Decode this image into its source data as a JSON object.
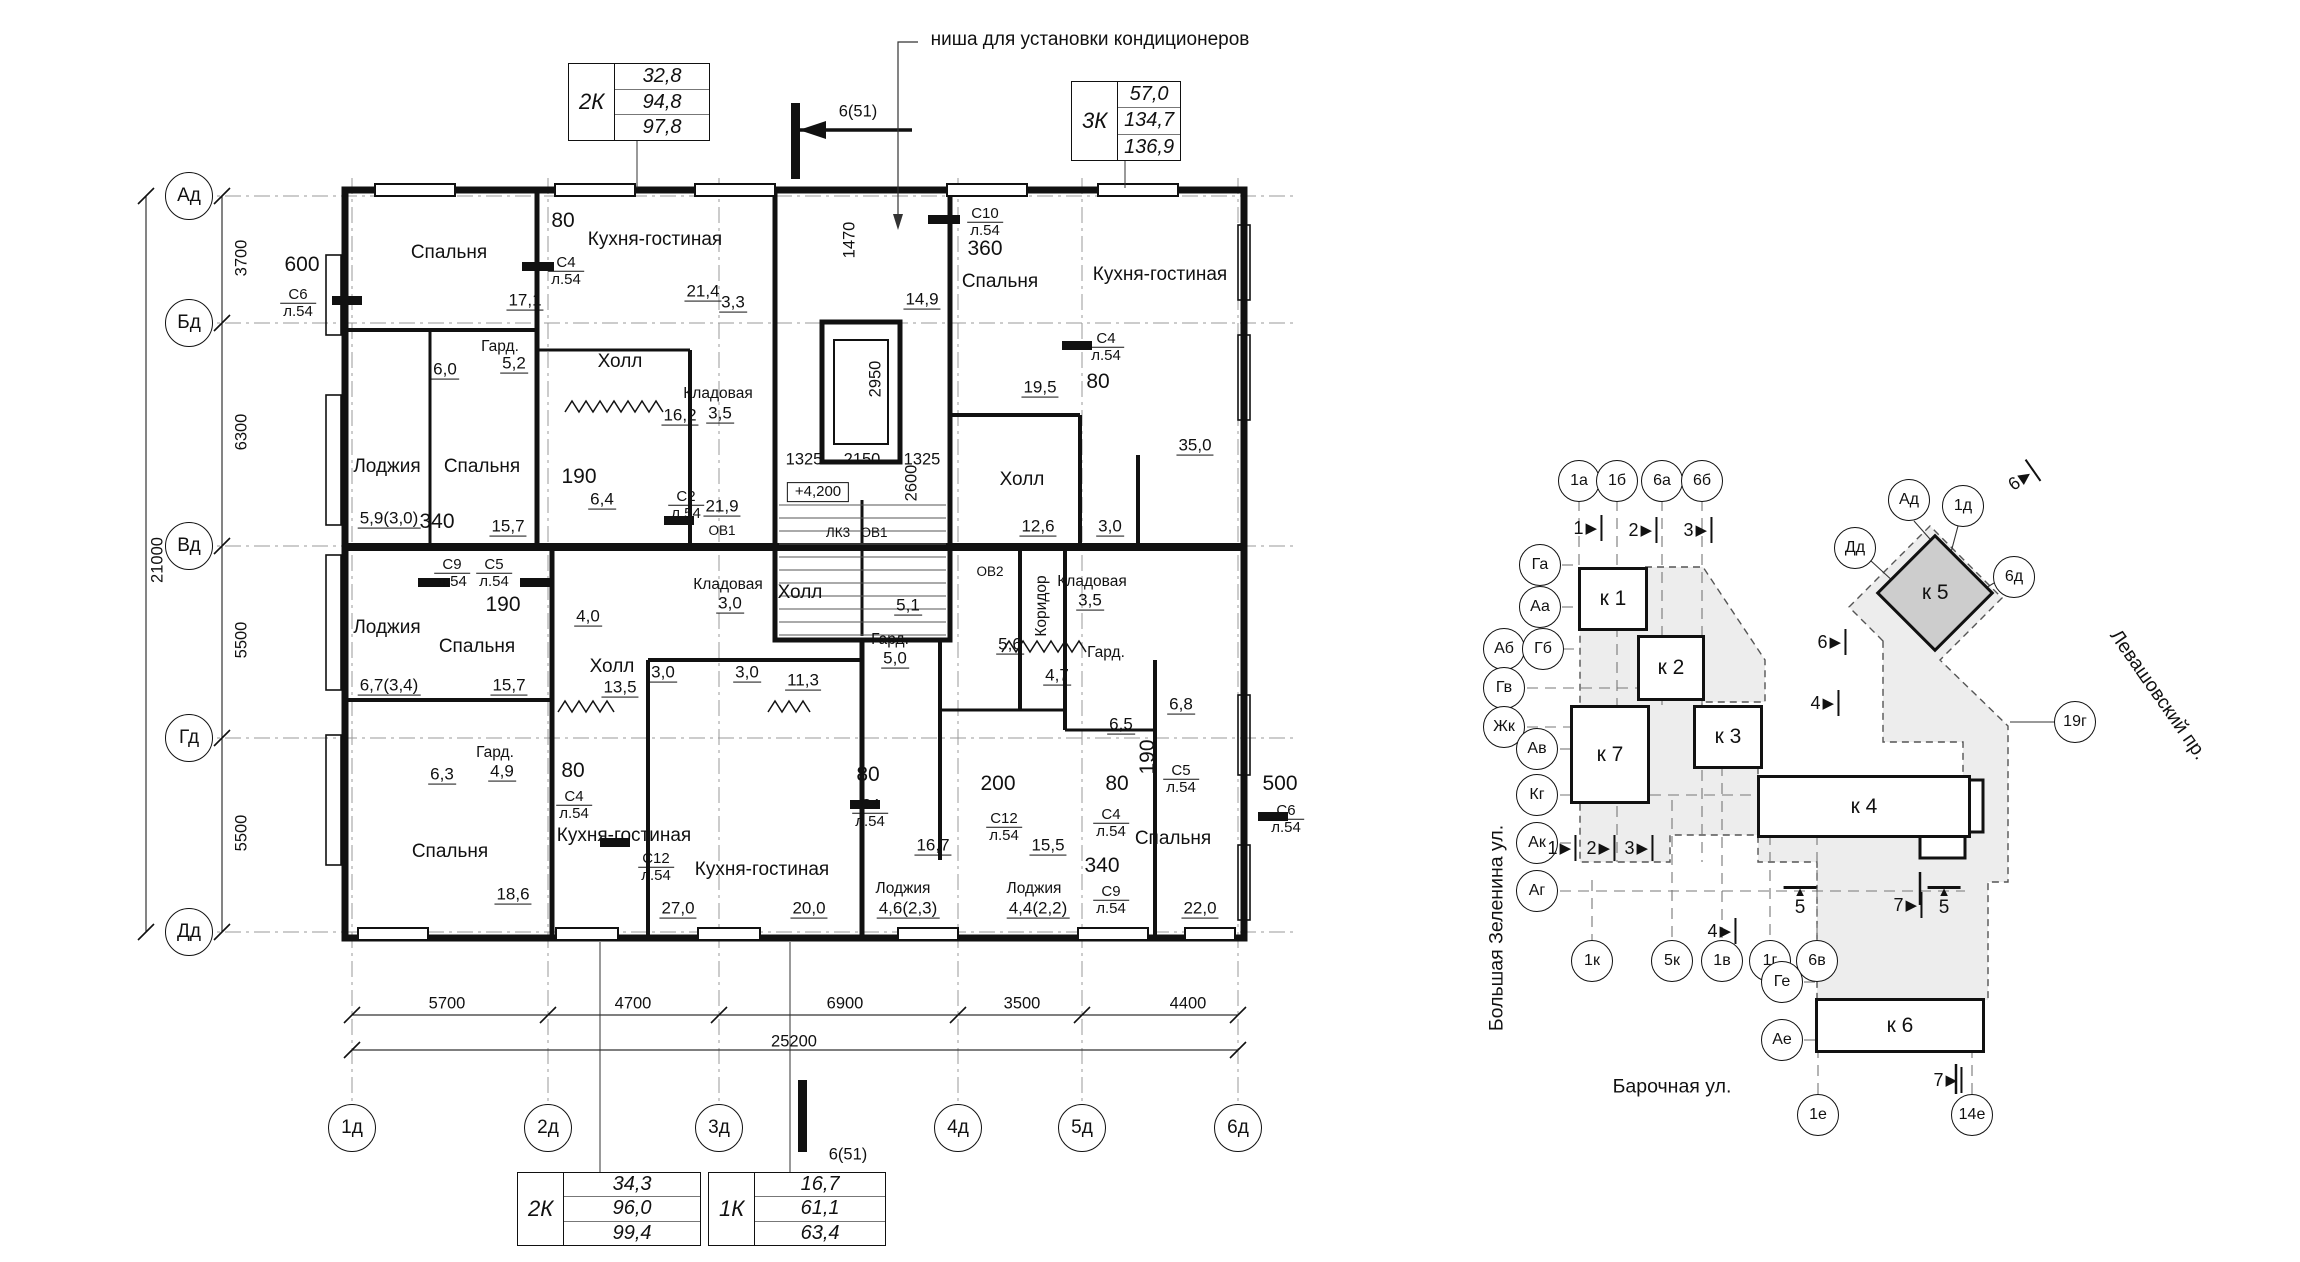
{
  "floor_plan": {
    "note": "ниша для установки кондиционеров",
    "area_tables": [
      {
        "label": "2К",
        "values": [
          "32,8",
          "94,8",
          "97,8"
        ],
        "x": 568,
        "y": 63,
        "w": 140,
        "h": 76
      },
      {
        "label": "3К",
        "values": [
          "57,0",
          "134,7",
          "136,9"
        ],
        "x": 1071,
        "y": 81,
        "w": 108,
        "h": 78
      },
      {
        "label": "2К",
        "values": [
          "34,3",
          "96,0",
          "99,4"
        ],
        "x": 517,
        "y": 1172,
        "w": 182,
        "h": 72
      },
      {
        "label": "1К",
        "values": [
          "16,7",
          "61,1",
          "63,4"
        ],
        "x": 708,
        "y": 1172,
        "w": 176,
        "h": 72
      }
    ],
    "axes_left": [
      {
        "label": "Ад",
        "y": 196
      },
      {
        "label": "Бд",
        "y": 323
      },
      {
        "label": "Вд",
        "y": 546
      },
      {
        "label": "Гд",
        "y": 738
      },
      {
        "label": "Дд",
        "y": 932
      }
    ],
    "axes_bottom": [
      {
        "label": "1д",
        "x": 352
      },
      {
        "label": "2д",
        "x": 548
      },
      {
        "label": "3д",
        "x": 719
      },
      {
        "label": "4д",
        "x": 958
      },
      {
        "label": "5д",
        "x": 1082
      },
      {
        "label": "6д",
        "x": 1238
      }
    ],
    "dims_left": [
      {
        "text": "3700",
        "x": 242,
        "y": 258
      },
      {
        "text": "6300",
        "x": 242,
        "y": 432
      },
      {
        "text": "5500",
        "x": 242,
        "y": 640
      },
      {
        "text": "5500",
        "x": 242,
        "y": 833
      },
      {
        "text": "21000",
        "x": 158,
        "y": 560
      }
    ],
    "dims_bottom": [
      {
        "text": "5700",
        "x": 447,
        "y": 1004
      },
      {
        "text": "4700",
        "x": 633,
        "y": 1004
      },
      {
        "text": "6900",
        "x": 845,
        "y": 1004
      },
      {
        "text": "3500",
        "x": 1022,
        "y": 1004
      },
      {
        "text": "4400",
        "x": 1188,
        "y": 1004
      },
      {
        "text": "25200",
        "x": 794,
        "y": 1042
      }
    ],
    "labels": [
      {
        "t": "Спальня",
        "x": 449,
        "y": 253,
        "c": "r"
      },
      {
        "t": "Кухня-гостиная",
        "x": 655,
        "y": 240,
        "c": "r"
      },
      {
        "t": "Спальня",
        "x": 1000,
        "y": 282,
        "c": "r"
      },
      {
        "t": "Кухня-гостиная",
        "x": 1160,
        "y": 275,
        "c": "r"
      },
      {
        "t": "Холл",
        "x": 620,
        "y": 362,
        "c": "r"
      },
      {
        "t": "Холл",
        "x": 1022,
        "y": 480,
        "c": "r"
      },
      {
        "t": "Лоджия",
        "x": 387,
        "y": 467,
        "c": "r"
      },
      {
        "t": "Спальня",
        "x": 482,
        "y": 467,
        "c": "r"
      },
      {
        "t": "Лоджия",
        "x": 387,
        "y": 628,
        "c": "r"
      },
      {
        "t": "Спальня",
        "x": 477,
        "y": 647,
        "c": "r"
      },
      {
        "t": "Холл",
        "x": 612,
        "y": 667,
        "c": "r"
      },
      {
        "t": "Холл",
        "x": 800,
        "y": 593,
        "c": "r"
      },
      {
        "t": "Спальня",
        "x": 450,
        "y": 852,
        "c": "r"
      },
      {
        "t": "Кухня-гостиная",
        "x": 624,
        "y": 836,
        "c": "r"
      },
      {
        "t": "Кухня-гостиная",
        "x": 762,
        "y": 870,
        "c": "r"
      },
      {
        "t": "Спальня",
        "x": 1173,
        "y": 839,
        "c": "r"
      },
      {
        "t": "Кладовая",
        "x": 718,
        "y": 394,
        "c": "rs"
      },
      {
        "t": "3,5",
        "x": 720,
        "y": 414,
        "c": "a"
      },
      {
        "t": "Кладовая",
        "x": 728,
        "y": 585,
        "c": "rs"
      },
      {
        "t": "3,0",
        "x": 730,
        "y": 604,
        "c": "a"
      },
      {
        "t": "Кладовая",
        "x": 1092,
        "y": 582,
        "c": "rs"
      },
      {
        "t": "3,5",
        "x": 1090,
        "y": 601,
        "c": "a"
      },
      {
        "t": "Гард.",
        "x": 500,
        "y": 347,
        "c": "rs"
      },
      {
        "t": "5,2",
        "x": 514,
        "y": 364,
        "c": "a"
      },
      {
        "t": "Гард.",
        "x": 495,
        "y": 753,
        "c": "rs"
      },
      {
        "t": "4,9",
        "x": 502,
        "y": 772,
        "c": "a"
      },
      {
        "t": "Гард.",
        "x": 890,
        "y": 640,
        "c": "rs"
      },
      {
        "t": "5,0",
        "x": 895,
        "y": 659,
        "c": "a"
      },
      {
        "t": "Гард.",
        "x": 1106,
        "y": 653,
        "c": "rs"
      },
      {
        "t": "Коридор",
        "x": 1042,
        "y": 606,
        "c": "rs",
        "r": -90
      },
      {
        "t": "Лоджия",
        "x": 903,
        "y": 889,
        "c": "rs"
      },
      {
        "t": "4,6(2,3)",
        "x": 908,
        "y": 909,
        "c": "a"
      },
      {
        "t": "Лоджия",
        "x": 1034,
        "y": 889,
        "c": "rs"
      },
      {
        "t": "4,4(2,2)",
        "x": 1038,
        "y": 909,
        "c": "a"
      },
      {
        "t": "17,1",
        "x": 525,
        "y": 301,
        "c": "a"
      },
      {
        "t": "21,4",
        "x": 703,
        "y": 292,
        "c": "a"
      },
      {
        "t": "16,2",
        "x": 680,
        "y": 416,
        "c": "a"
      },
      {
        "t": "3,3",
        "x": 733,
        "y": 303,
        "c": "a"
      },
      {
        "t": "6,0",
        "x": 445,
        "y": 370,
        "c": "a"
      },
      {
        "t": "35,0",
        "x": 1195,
        "y": 446,
        "c": "a"
      },
      {
        "t": "19,5",
        "x": 1040,
        "y": 388,
        "c": "a"
      },
      {
        "t": "12,6",
        "x": 1038,
        "y": 527,
        "c": "a"
      },
      {
        "t": "3,0",
        "x": 1110,
        "y": 527,
        "c": "a"
      },
      {
        "t": "14,9",
        "x": 922,
        "y": 300,
        "c": "a"
      },
      {
        "t": "5,9(3,0)",
        "x": 389,
        "y": 519,
        "c": "a"
      },
      {
        "t": "15,7",
        "x": 508,
        "y": 527,
        "c": "a"
      },
      {
        "t": "6,4",
        "x": 602,
        "y": 500,
        "c": "a"
      },
      {
        "t": "21,9",
        "x": 722,
        "y": 507,
        "c": "a"
      },
      {
        "t": "4,0",
        "x": 588,
        "y": 617,
        "c": "a"
      },
      {
        "t": "13,5",
        "x": 620,
        "y": 688,
        "c": "a"
      },
      {
        "t": "11,3",
        "x": 803,
        "y": 681,
        "c": "a"
      },
      {
        "t": "3,0",
        "x": 663,
        "y": 673,
        "c": "a"
      },
      {
        "t": "3,0",
        "x": 747,
        "y": 673,
        "c": "a"
      },
      {
        "t": "5,1",
        "x": 908,
        "y": 606,
        "c": "a"
      },
      {
        "t": "5,6",
        "x": 1010,
        "y": 645,
        "c": "a"
      },
      {
        "t": "4,7",
        "x": 1057,
        "y": 676,
        "c": "a"
      },
      {
        "t": "6,7(3,4)",
        "x": 389,
        "y": 686,
        "c": "a"
      },
      {
        "t": "15,7",
        "x": 509,
        "y": 686,
        "c": "a"
      },
      {
        "t": "6,3",
        "x": 442,
        "y": 775,
        "c": "a"
      },
      {
        "t": "18,6",
        "x": 513,
        "y": 895,
        "c": "a"
      },
      {
        "t": "27,0",
        "x": 678,
        "y": 909,
        "c": "a"
      },
      {
        "t": "20,0",
        "x": 809,
        "y": 909,
        "c": "a"
      },
      {
        "t": "16,7",
        "x": 933,
        "y": 846,
        "c": "a"
      },
      {
        "t": "15,5",
        "x": 1048,
        "y": 846,
        "c": "a"
      },
      {
        "t": "22,0",
        "x": 1200,
        "y": 909,
        "c": "a"
      },
      {
        "t": "6,5",
        "x": 1121,
        "y": 725,
        "c": "a"
      },
      {
        "t": "6,8",
        "x": 1181,
        "y": 705,
        "c": "a"
      },
      {
        "t": "600",
        "x": 302,
        "y": 265,
        "c": "o"
      },
      {
        "t": "80",
        "x": 563,
        "y": 221,
        "c": "o"
      },
      {
        "t": "340",
        "x": 437,
        "y": 522,
        "c": "o"
      },
      {
        "t": "190",
        "x": 579,
        "y": 477,
        "c": "o"
      },
      {
        "t": "190",
        "x": 503,
        "y": 605,
        "c": "o"
      },
      {
        "t": "80",
        "x": 1098,
        "y": 382,
        "c": "o"
      },
      {
        "t": "360",
        "x": 985,
        "y": 249,
        "c": "o"
      },
      {
        "t": "80",
        "x": 573,
        "y": 771,
        "c": "o"
      },
      {
        "t": "80",
        "x": 868,
        "y": 775,
        "c": "o"
      },
      {
        "t": "200",
        "x": 998,
        "y": 784,
        "c": "o"
      },
      {
        "t": "80",
        "x": 1117,
        "y": 784,
        "c": "o"
      },
      {
        "t": "340",
        "x": 1102,
        "y": 866,
        "c": "o"
      },
      {
        "t": "500",
        "x": 1280,
        "y": 784,
        "c": "o"
      },
      {
        "t": "190",
        "x": 1148,
        "y": 757,
        "c": "o",
        "r": -90
      },
      {
        "t": "1470",
        "x": 850,
        "y": 240,
        "c": "d",
        "r": -90
      },
      {
        "t": "2950",
        "x": 876,
        "y": 379,
        "c": "d",
        "r": -90
      },
      {
        "t": "2600",
        "x": 912,
        "y": 483,
        "c": "d",
        "r": -90
      },
      {
        "t": "1325",
        "x": 804,
        "y": 460,
        "c": "d"
      },
      {
        "t": "2150",
        "x": 862,
        "y": 460,
        "c": "d"
      },
      {
        "t": "1325",
        "x": 922,
        "y": 460,
        "c": "d"
      },
      {
        "t": "6(51)",
        "x": 858,
        "y": 112,
        "c": "d"
      },
      {
        "t": "6(51)",
        "x": 848,
        "y": 1155,
        "c": "d"
      },
      {
        "t": "С6|л.54",
        "x": 298,
        "y": 303,
        "c": "s"
      },
      {
        "t": "С4|л.54",
        "x": 566,
        "y": 271,
        "c": "s"
      },
      {
        "t": "С10|л.54",
        "x": 985,
        "y": 222,
        "c": "s"
      },
      {
        "t": "С4|л.54",
        "x": 1106,
        "y": 347,
        "c": "s"
      },
      {
        "t": "С2|л.54",
        "x": 686,
        "y": 505,
        "c": "s"
      },
      {
        "t": "С9|л.54",
        "x": 452,
        "y": 573,
        "c": "s"
      },
      {
        "t": "С5|л.54",
        "x": 494,
        "y": 573,
        "c": "s"
      },
      {
        "t": "С4|л.54",
        "x": 574,
        "y": 805,
        "c": "s"
      },
      {
        "t": "С12|л.54",
        "x": 656,
        "y": 867,
        "c": "s"
      },
      {
        "t": "С4|л.54",
        "x": 870,
        "y": 813,
        "c": "s"
      },
      {
        "t": "С12|л.54",
        "x": 1004,
        "y": 827,
        "c": "s"
      },
      {
        "t": "С9|л.54",
        "x": 1111,
        "y": 900,
        "c": "s"
      },
      {
        "t": "С4|л.54",
        "x": 1111,
        "y": 823,
        "c": "s"
      },
      {
        "t": "С5|л.54",
        "x": 1181,
        "y": 779,
        "c": "s"
      },
      {
        "t": "С6|л.54",
        "x": 1286,
        "y": 819,
        "c": "s"
      },
      {
        "t": "ОВ1",
        "x": 722,
        "y": 531,
        "c": "t"
      },
      {
        "t": "ЛК3",
        "x": 838,
        "y": 533,
        "c": "t"
      },
      {
        "t": "ОВ1",
        "x": 874,
        "y": 533,
        "c": "t"
      },
      {
        "t": "ОВ2",
        "x": 990,
        "y": 572,
        "c": "t"
      },
      {
        "t": "+4,200",
        "x": 818,
        "y": 492,
        "c": "e"
      }
    ]
  },
  "site_plan": {
    "buildings": [
      {
        "label": "к 1",
        "x": 1578,
        "y": 567,
        "w": 64,
        "h": 58
      },
      {
        "label": "к 2",
        "x": 1637,
        "y": 635,
        "w": 62,
        "h": 60
      },
      {
        "label": "к 7",
        "x": 1570,
        "y": 705,
        "w": 74,
        "h": 93
      },
      {
        "label": "к 3",
        "x": 1693,
        "y": 705,
        "w": 64,
        "h": 58
      },
      {
        "label": "к 4",
        "x": 1757,
        "y": 775,
        "w": 208,
        "h": 57
      },
      {
        "label": "к 6",
        "x": 1815,
        "y": 998,
        "w": 164,
        "h": 49
      },
      {
        "label": "к 5",
        "x": 1893,
        "y": 551,
        "w": 78,
        "h": 78,
        "shape": "diamond",
        "fill": "#cdcdcd"
      }
    ],
    "bubbles": [
      {
        "t": "1а",
        "x": 1579,
        "y": 481
      },
      {
        "t": "1б",
        "x": 1617,
        "y": 481
      },
      {
        "t": "6а",
        "x": 1662,
        "y": 481
      },
      {
        "t": "6б",
        "x": 1702,
        "y": 481
      },
      {
        "t": "Га",
        "x": 1540,
        "y": 565
      },
      {
        "t": "Аа",
        "x": 1540,
        "y": 607
      },
      {
        "t": "Аб",
        "x": 1504,
        "y": 649
      },
      {
        "t": "Гб",
        "x": 1543,
        "y": 649
      },
      {
        "t": "Гв",
        "x": 1504,
        "y": 688
      },
      {
        "t": "Жк",
        "x": 1504,
        "y": 727
      },
      {
        "t": "Ав",
        "x": 1537,
        "y": 749
      },
      {
        "t": "Кг",
        "x": 1537,
        "y": 795
      },
      {
        "t": "Ак",
        "x": 1537,
        "y": 843
      },
      {
        "t": "Аг",
        "x": 1537,
        "y": 891
      },
      {
        "t": "1к",
        "x": 1592,
        "y": 961
      },
      {
        "t": "5к",
        "x": 1672,
        "y": 961
      },
      {
        "t": "1в",
        "x": 1722,
        "y": 961
      },
      {
        "t": "1г",
        "x": 1770,
        "y": 961
      },
      {
        "t": "6в",
        "x": 1817,
        "y": 961
      },
      {
        "t": "Ад",
        "x": 1909,
        "y": 500
      },
      {
        "t": "1д",
        "x": 1963,
        "y": 506
      },
      {
        "t": "Дд",
        "x": 1855,
        "y": 548
      },
      {
        "t": "6д",
        "x": 2014,
        "y": 577
      },
      {
        "t": "19г",
        "x": 2075,
        "y": 722
      },
      {
        "t": "Ге",
        "x": 1782,
        "y": 982
      },
      {
        "t": "Ае",
        "x": 1782,
        "y": 1040
      },
      {
        "t": "1е",
        "x": 1818,
        "y": 1115
      },
      {
        "t": "14е",
        "x": 1972,
        "y": 1115
      }
    ],
    "markers": [
      {
        "t": "1",
        "g": "right",
        "x": 1588,
        "y": 528
      },
      {
        "t": "2",
        "g": "right",
        "x": 1643,
        "y": 530
      },
      {
        "t": "3",
        "g": "right",
        "x": 1698,
        "y": 530
      },
      {
        "t": "1",
        "g": "right",
        "x": 1562,
        "y": 848
      },
      {
        "t": "2",
        "g": "right",
        "x": 1601,
        "y": 848
      },
      {
        "t": "3",
        "g": "right",
        "x": 1639,
        "y": 848
      },
      {
        "t": "4",
        "g": "right",
        "x": 1825,
        "y": 703
      },
      {
        "t": "4",
        "g": "right",
        "x": 1722,
        "y": 931
      },
      {
        "t": "6",
        "g": "right",
        "x": 1832,
        "y": 642
      },
      {
        "t": "6",
        "g": "right",
        "x": 2022,
        "y": 478,
        "r": -35
      },
      {
        "t": "7",
        "g": "right",
        "x": 1908,
        "y": 905
      },
      {
        "t": "7",
        "g": "right",
        "x": 1948,
        "y": 1080
      },
      {
        "t": "5",
        "g": "flag",
        "x": 1800,
        "y": 886
      },
      {
        "t": "5",
        "g": "flag",
        "x": 1944,
        "y": 886
      }
    ],
    "streets": [
      {
        "t": "Большая Зеленина ул.",
        "x": 1497,
        "y": 928,
        "r": -90
      },
      {
        "t": "Барочная ул.",
        "x": 1672,
        "y": 1087,
        "r": 0
      },
      {
        "t": "Левашовский пр.",
        "x": 2158,
        "y": 695,
        "r": 55
      }
    ]
  }
}
